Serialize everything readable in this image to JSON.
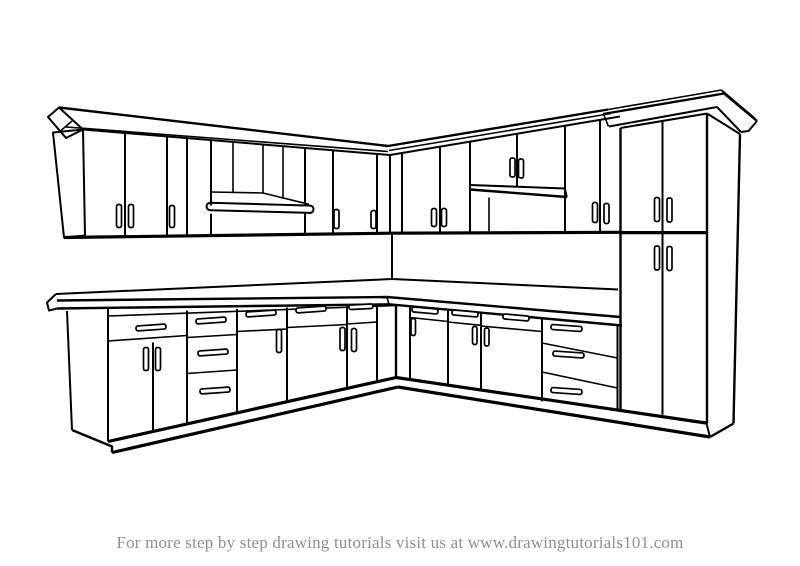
{
  "canvas": {
    "width": 800,
    "height": 566,
    "background_color": "#ffffff"
  },
  "drawing": {
    "subject": "L-shaped kitchen cabinets",
    "style": "black and white line drawing",
    "line_color": "#000000",
    "fill_color": "#ffffff",
    "components": [
      "upper wall cabinets with crown molding",
      "range hood niche",
      "open shelf niche with two small doors",
      "tall pantry cabinet with crown molding",
      "countertop with backsplash corner",
      "base cabinets with doors and drawer banks",
      "toe kick",
      "door and drawer handles"
    ]
  },
  "footer": {
    "text": "For more step by step drawing tutorials visit us at www.drawingtutorials101.com",
    "color": "#8f8f8f"
  }
}
